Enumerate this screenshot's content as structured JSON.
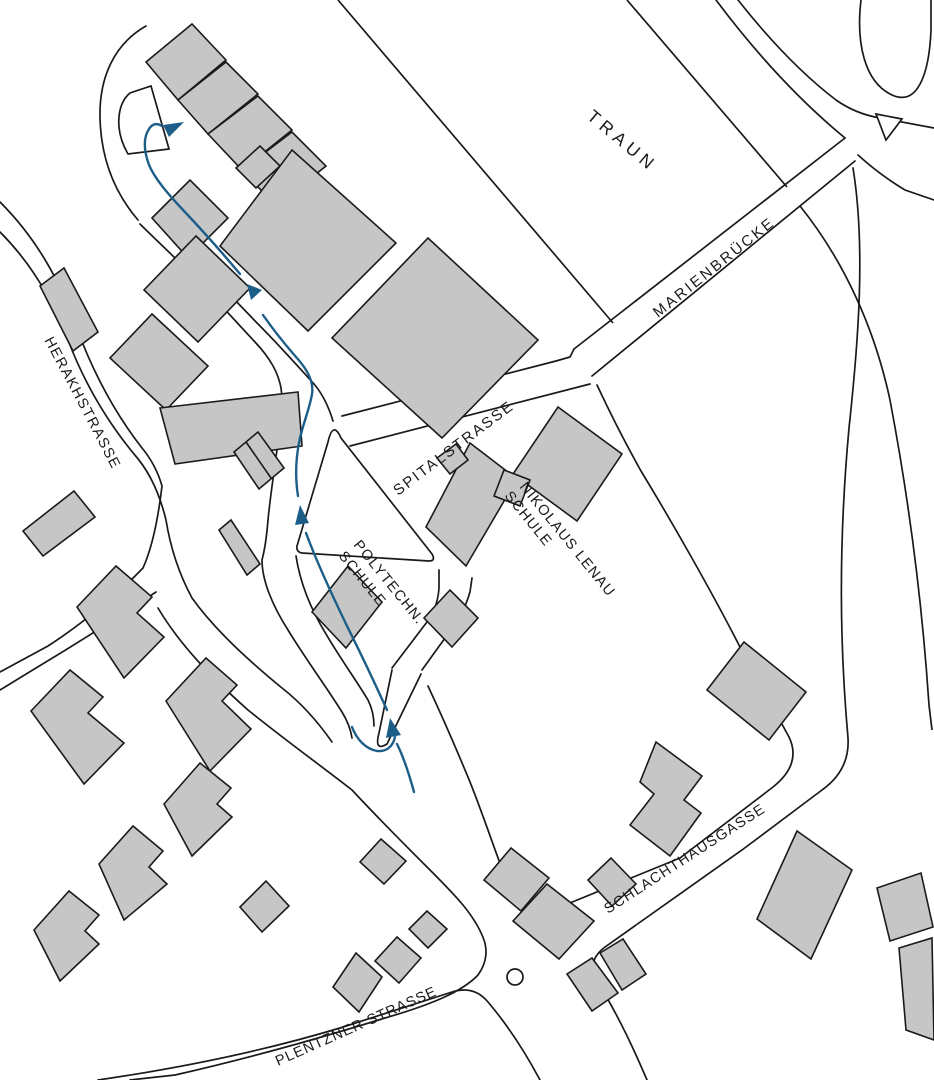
{
  "map": {
    "width": 934,
    "height": 1080,
    "colors": {
      "background": "#ffffff",
      "line": "#1a1a1a",
      "building_fill": "#c6c6c6",
      "building_stroke": "#1a1a1a",
      "route": "#1c5e88",
      "label": "#1a1a1a"
    },
    "labels": [
      {
        "id": "label-traun",
        "text": "TRAUN",
        "x": 586,
        "y": 118,
        "rotate": 40,
        "size": 17.5,
        "spacing": 5
      },
      {
        "id": "label-marienbruecke",
        "text": "MARIENBRÜCKE",
        "x": 658,
        "y": 318,
        "rotate": -38.5,
        "size": 15,
        "spacing": 2.5
      },
      {
        "id": "label-spitalstrasse",
        "text": "SPITALSTRASSE",
        "x": 398,
        "y": 496,
        "rotate": -37,
        "size": 15,
        "spacing": 2
      },
      {
        "id": "label-nikolaus-lenau",
        "text": "NIKOLAUS LENAU",
        "x": 519,
        "y": 487,
        "rotate": 51,
        "size": 14.5,
        "spacing": 1.2
      },
      {
        "id": "label-nikolaus-lenau-schule",
        "text": "SCHULE",
        "x": 504,
        "y": 496,
        "rotate": 51,
        "size": 14.5,
        "spacing": 1.2
      },
      {
        "id": "label-polytechn",
        "text": "POLYTECHN.",
        "x": 353,
        "y": 545,
        "rotate": 51,
        "size": 14.5,
        "spacing": 1.2
      },
      {
        "id": "label-polytechn-schule",
        "text": "SCHULE",
        "x": 338,
        "y": 556,
        "rotate": 51,
        "size": 14.5,
        "spacing": 1.2
      },
      {
        "id": "label-schlachthausgasse",
        "text": "SCHLACHTHAUSGASSE",
        "x": 608,
        "y": 914,
        "rotate": -33,
        "size": 14.5,
        "spacing": 1.2
      },
      {
        "id": "label-plentzner-strasse",
        "text": "PLENTZNER STRASSE",
        "x": 278,
        "y": 1066,
        "rotate": -24,
        "size": 14.5,
        "spacing": 1
      }
    ],
    "curved_labels": [
      {
        "id": "label-herakhstrasse",
        "text": "HERAKHSTRASSE",
        "path": "M44,340 C72,392 92,430 128,500",
        "size": 14.5,
        "spacing": 1.5
      }
    ],
    "roads": [
      "M0,202 C34,236 58,276 76,326 C92,370 114,412 142,448 C152,460 158,472 162,486 C158,520 152,548 143,568 C120,592 85,622 48,646 L0,672",
      "M0,232 C30,262 52,298 68,340 C84,382 106,420 134,454 C150,472 160,495 166,520 C170,545 178,572 192,598 C215,630 248,660 282,688 C300,702 318,722 332,742",
      "M156,592 C120,616 76,644 36,668 L0,690",
      "M158,608 C180,645 212,678 248,710 C285,740 320,765 352,790 C378,818 400,840 428,868 C455,895 475,915 484,940 Q490,958 478,975 C462,992 430,1005 385,1018 C330,1035 250,1058 175,1075 L130,1080",
      "M140,224 C158,242 180,262 205,288 L255,342 C270,358 278,372 281,388 Q283,400 281,416 C278,448 271,488 268,520 Q266,545 262,560 C262,580 272,605 288,630 C305,658 325,685 342,712 Q350,725 352,738",
      "M333,421 Q326,398 314,384 C296,364 276,342 258,324 L232,297",
      "M296,556 C300,582 310,608 326,634 C340,658 356,680 368,700 Q374,712 374,726",
      "M392,668 L430,618 Q438,604 439,588 L439,570",
      "M422,670 L458,620 Q466,606 470,592 L472,578",
      "M428,686 C442,716 456,748 470,782 C482,812 492,842 501,866 Q512,896 536,906 Q550,911 565,905 L680,858 L773,787 Q802,764 789,737 L741,649 C712,592 672,522 641,471 Q618,430 597,385",
      "M342,416 L556,361 L570,357 L574,349",
      "M350,446 L590,384",
      "M574,349 L845,138",
      "M592,376 L855,161",
      "M98,1080 C180,1068 260,1052 340,1028 L452,992 Q474,985 488,1002 C505,1022 524,1050 540,1080",
      "M647,1080 C630,1040 612,1005 598,983 Q585,962 605,947 L742,850 L822,790 Q850,770 848,738 C840,648 838,548 849,428 C858,345 866,248 853,168",
      "M716,0 C752,48 794,96 845,138",
      "M738,0 C768,38 802,74 836,100 Q856,114 880,118 L934,128",
      "M858,155 Q880,175 905,190 L934,200",
      "M861,0 C856,42 864,82 892,95 C916,106 929,78 931,30 L931,0",
      "M146,26 C114,44 99,78 100,118 C101,158 114,192 138,220",
      "M392,670 L379,733 Q374,752 387,744 L421,674"
    ],
    "river_banks": [
      "M338,0 L613,323",
      "M627,0 L787,187",
      "M800,206 C845,262 875,330 890,400 C908,495 922,600 929,705 L932,730"
    ],
    "islands": [
      "M151,86 L169,149 L128,154 C114,130 117,104 130,93 Z",
      "M297,546 L328,442 Q333,420 341,438 L432,554 Q436,561 429,561 L302,553 Q296,552 297,546 Z"
    ],
    "triangle_island": "876,114 902,119 886,140",
    "roundabout": {
      "cx": 515,
      "cy": 977,
      "r": 8
    },
    "buildings": [
      "146,62 192,24 226,60 178,100",
      "178,100 226,62 258,94 208,134",
      "208,134 258,96 292,130 242,170",
      "242,170 292,132 326,166 276,206",
      "236,168 260,146 280,166 256,188",
      "152,218 190,180 228,218 188,258",
      "196,236 250,288 198,342 144,290",
      "152,314 208,366 166,410 110,358",
      "160,408 298,392 302,446 175,464",
      "219,530 231,520 260,564 247,575",
      "40,286 64,268 98,332 73,351",
      "234,452 258,432 284,468 259,489",
      "292,150 396,243 308,331 220,246",
      "428,238 538,340 442,438 332,338",
      "312,612 348,566 382,602 346,648",
      "424,618 450,590 478,618 452,647",
      "470,443 517,479 466,566 426,527",
      "437,458 456,444 468,460 450,474",
      "558,407 622,454 577,521 513,474",
      "504,470 530,480 520,506 494,496",
      "744,642 806,692 769,740 707,690",
      "656,742 702,776 684,800 701,813 670,856 630,825 654,794 640,782",
      "588,880 611,858 636,884 612,906",
      "600,953 623,939 646,974 622,990",
      "567,974 592,958 618,993 592,1011",
      "797,831 852,870 811,959 757,919",
      "877,888 921,873 933,927 890,941",
      "899,948 932,938 934,1040 906,1030",
      "511,848 549,878 521,911 484,880",
      "547,884 594,921 559,959 513,921",
      "381,839 406,861 384,884 360,862",
      "427,911 447,929 428,948 409,929",
      "397,937 421,958 399,983 375,961",
      "356,953 382,977 359,1012 333,987",
      "23,531 74,491 95,517 43,556",
      "77,607 116,566 152,597 137,613 164,637 124,678",
      "31,711 70,670 103,697 88,713 124,743 84,784",
      "166,701 206,658 237,685 222,701 251,729 210,771",
      "99,864 133,826 163,851 149,867 167,884 124,920",
      "34,930 69,891 99,915 85,931 99,944 60,981",
      "164,804 200,763 231,788 217,804 232,817 192,856",
      "240,907 266,881 289,906 262,932"
    ],
    "building_lines": [
      "M246,442 L271,478"
    ],
    "route": {
      "segments": [
        "M414,792 C408,770 402,754 397,744",
        "M352,727 C357,740 366,749 377,751 C387,752 393,746 395,737",
        "M387,710 C377,688 362,656 348,628 C331,593 316,560 306,533",
        "M298,496 C295,477 296,456 300,438 C304,421 310,407 312,394 C314,382 307,369 296,357 C283,342 272,328 263,315",
        "M240,274 C220,250 200,228 184,211 C168,194 155,179 149,165 C144,151 143,138 149,129 Q154,121 162,126"
      ],
      "arrows": [
        "390,718 401,735 386,738",
        "300,505 309,523 295,525",
        "247,284 262,290 251,300",
        "184,122 169,137 163,125"
      ]
    }
  }
}
